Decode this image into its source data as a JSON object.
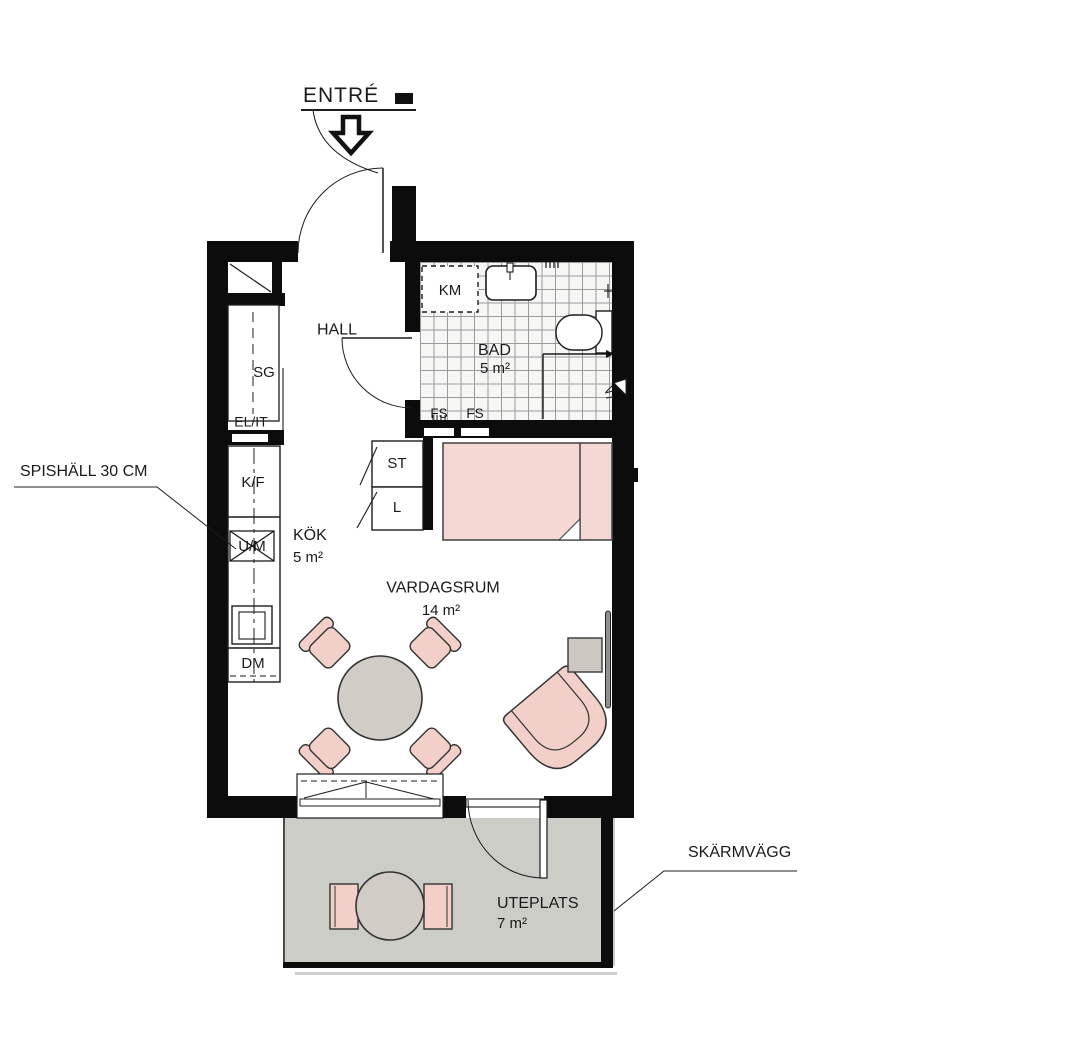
{
  "annotations": {
    "entrance": "ENTRÉ",
    "hob": "SPISHÄLL 30 CM",
    "screen_wall": "SKÄRMVÄGG"
  },
  "rooms": {
    "hall": {
      "name": "HALL"
    },
    "bathroom": {
      "name": "BAD",
      "area": "5 m²"
    },
    "kitchen": {
      "name": "KÖK",
      "area": "5 m²"
    },
    "living": {
      "name": "VARDAGSRUM",
      "area": "14 m²"
    },
    "patio": {
      "name": "UTEPLATS",
      "area": "7 m²"
    }
  },
  "fixtures": {
    "km": "KM",
    "sg": "SG",
    "el_it": "EL/IT",
    "kf": "K/F",
    "um": "U/M",
    "dm": "DM",
    "st": "ST",
    "l": "L",
    "fs": "FS"
  },
  "colors": {
    "wall": "#0c0c0c",
    "line": "#1c1c1c",
    "chair-pink": "#f2cfc9",
    "bed-pink": "#f5d8d3",
    "patio-grey": "#cdcdc7",
    "table-grey": "#d2ccc6",
    "tile-bg": "#f6f6f4",
    "tile-line": "#9b9b9b",
    "text": "#1a1a1a"
  }
}
